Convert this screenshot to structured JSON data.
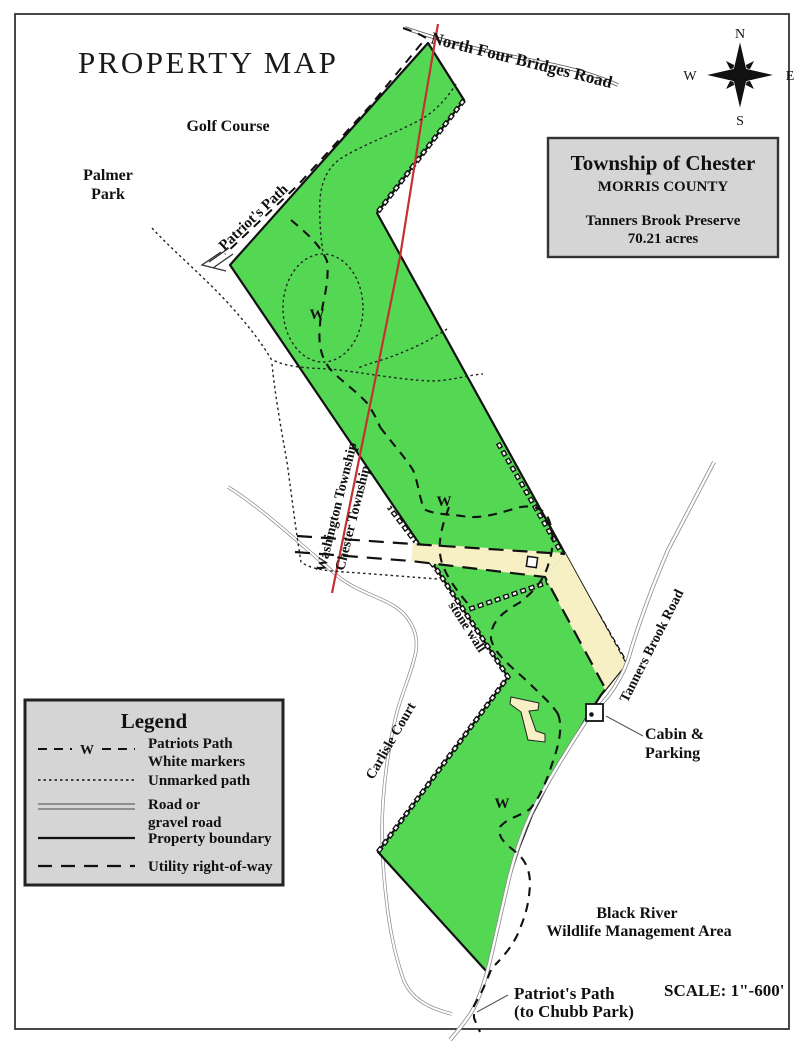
{
  "title": "PROPERTY MAP",
  "compass": {
    "n": "N",
    "e": "E",
    "s": "S",
    "w": "W"
  },
  "info_box": {
    "township": "Township of Chester",
    "county": "MORRIS COUNTY",
    "preserve": "Tanners Brook Preserve",
    "acreage": "70.21 acres"
  },
  "area_labels": {
    "golf_course": "Golf Course",
    "palmer_park_line1": "Palmer",
    "palmer_park_line2": "Park",
    "black_river_line1": "Black River",
    "black_river_line2": "Wildlife Management Area"
  },
  "road_labels": {
    "north_four_bridges": "North Four Bridges Road",
    "tanners_brook": "Tanners Brook Road",
    "carlisle_court": "Carlisle Court"
  },
  "path_labels": {
    "patriots_path_top": "Patriot's Path",
    "patriots_path_bottom_line1": "Patriot's Path",
    "patriots_path_bottom_line2": "(to Chubb Park)",
    "stone_wall": "stone wall"
  },
  "township_labels": {
    "washington": "Washington Township",
    "chester": "Chester Township"
  },
  "feature_labels": {
    "cabin_line1": "Cabin &",
    "cabin_line2": "Parking"
  },
  "trail_marker": "W",
  "legend": {
    "title": "Legend",
    "marker": "W",
    "items": [
      {
        "line1": "Patriots Path",
        "line2": "White markers"
      },
      {
        "line1": "Unmarked path",
        "line2": ""
      },
      {
        "line1": "Road or",
        "line2": "gravel road"
      },
      {
        "line1": "Property boundary",
        "line2": ""
      },
      {
        "line1": "Utility right-of-way",
        "line2": ""
      }
    ]
  },
  "scale_label": "SCALE: 1\"-600'",
  "colors": {
    "preserve_green": "#54d854",
    "utility_cream": "#f6f0c4",
    "panel_gray": "#d5d5d5",
    "township_line_red": "#c43131",
    "road_gray": "#8a8a8a",
    "ink": "#111111"
  }
}
